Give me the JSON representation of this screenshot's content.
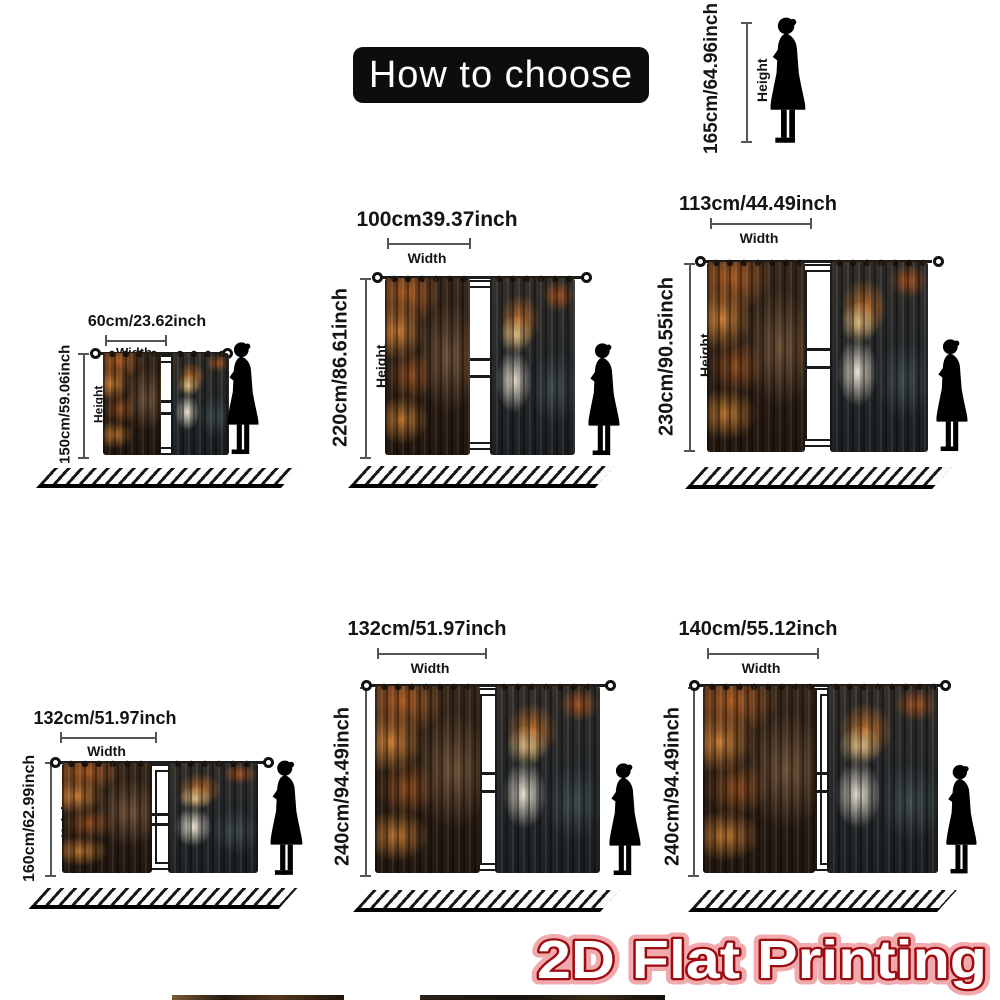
{
  "title": "How to choose",
  "reference_person": {
    "height_value": "165cm/64.96inch",
    "height_caption": "Height"
  },
  "captions": {
    "width": "Width",
    "height": "Height"
  },
  "sizes": [
    {
      "width": "60cm/23.62inch",
      "height": "150cm/59.06inch"
    },
    {
      "width": "100cm39.37inch",
      "height": "220cm/86.61inch"
    },
    {
      "width": "113cm/44.49inch",
      "height": "230cm/90.55inch"
    },
    {
      "width": "132cm/51.97inch",
      "height": "160cm/62.99inch"
    },
    {
      "width": "132cm/51.97inch",
      "height": "240cm/94.49inch"
    },
    {
      "width": "140cm/55.12inch",
      "height": "240cm/94.49inch"
    }
  ],
  "footer_badge": "2D Flat Printing",
  "icons": {
    "person": "woman-silhouette"
  },
  "colors": {
    "title_bg": "#0d0d0d",
    "title_text": "#ffffff",
    "badge_fill": "#ffffff",
    "badge_outline": "#9c0b10",
    "badge_glow": "#f0a9ac",
    "measure_line": "#555555",
    "text": "#141414"
  }
}
